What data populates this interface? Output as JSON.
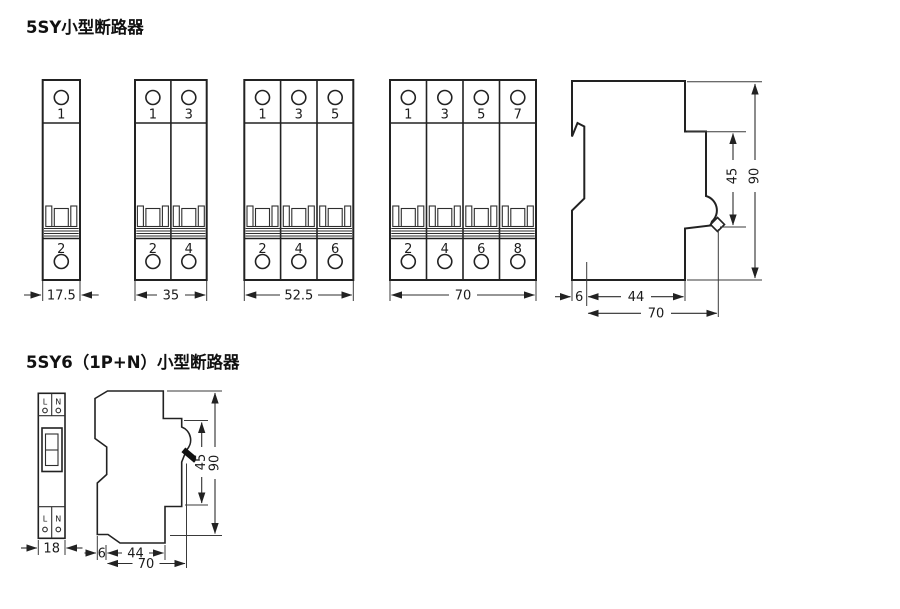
{
  "section1": {
    "title": "5SY小型断路器",
    "breakers": [
      {
        "width_label": "17.5",
        "top": [
          "1"
        ],
        "bottom": [
          "2"
        ]
      },
      {
        "width_label": "35",
        "top": [
          "1",
          "3"
        ],
        "bottom": [
          "2",
          "4"
        ]
      },
      {
        "width_label": "52.5",
        "top": [
          "1",
          "3",
          "5"
        ],
        "bottom": [
          "2",
          "4",
          "6"
        ]
      },
      {
        "width_label": "70",
        "top": [
          "1",
          "3",
          "5",
          "7"
        ],
        "bottom": [
          "2",
          "4",
          "6",
          "8"
        ]
      }
    ],
    "side": {
      "height": "90",
      "handle_height": "45",
      "rail_offset": "6",
      "body_depth": "44",
      "total_depth": "70"
    }
  },
  "section2": {
    "title": "5SY6（1P+N）小型断路器",
    "front": {
      "width_label": "18",
      "top": [
        "L",
        "N"
      ],
      "bottom": [
        "L",
        "N"
      ]
    },
    "side": {
      "height": "90",
      "handle_height": "45",
      "rail_offset": "6",
      "body_depth": "44",
      "total_depth": "70"
    }
  },
  "colors": {
    "ink": "#222222",
    "background": "#ffffff"
  }
}
